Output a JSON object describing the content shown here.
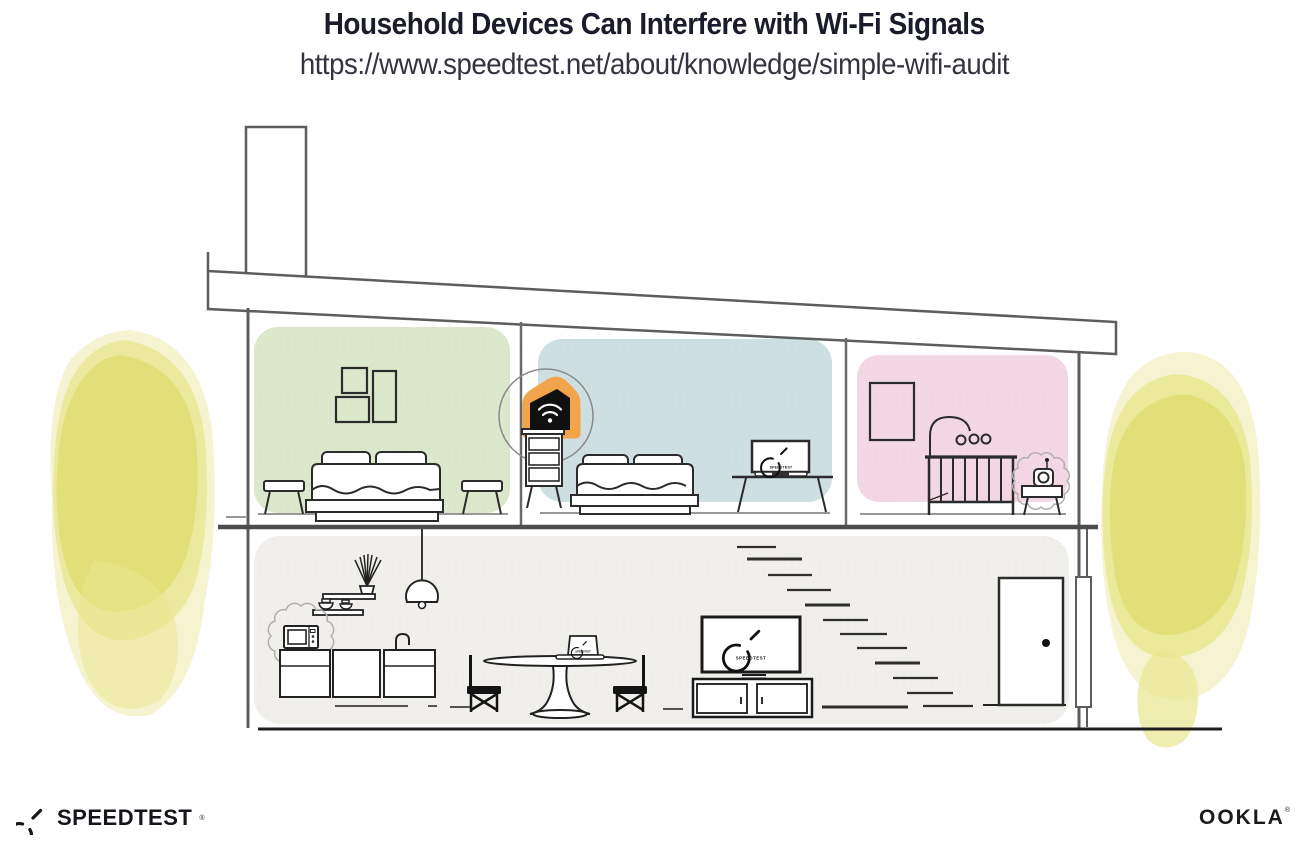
{
  "header": {
    "title": "Household Devices Can Interfere with Wi-Fi Signals",
    "url": "https://www.speedtest.net/about/knowledge/simple-wifi-audit"
  },
  "screens": {
    "tv_label": "SPEEDTEST",
    "bedroom_laptop_label": "SPEEDTEST",
    "dining_laptop_label": "SPEEDTEST"
  },
  "footer": {
    "speedtest_wordmark": "SPEEDTEST",
    "speedtest_reg_mark": "®",
    "ookla_wordmark": "OOKLA",
    "ookla_reg_mark": "®"
  },
  "colors": {
    "title_text": "#1a1c2b",
    "url_text": "#33343f",
    "room_green": "#dce8cb",
    "room_blue": "#cedfe2",
    "room_pink": "#f3d7e4",
    "lower_floor_bg": "#f0efec",
    "tree_core": "#e1de74",
    "tree_mid": "#e9e690",
    "tree_halo": "#f2f0c4",
    "router_highlight": "#f2a44b",
    "interference_gray": "#b3b0ab",
    "structure_gray": "#5d5d5d",
    "ink": "#222222"
  }
}
